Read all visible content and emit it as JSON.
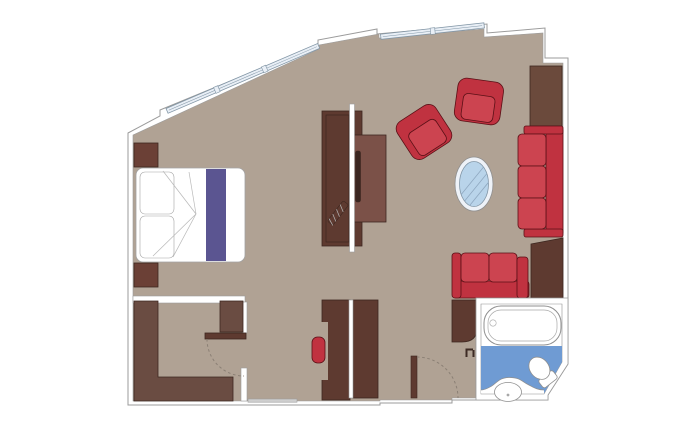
{
  "title": "Suite floor plan",
  "plan_type": "cruise-suite-floor-plan",
  "rooms": [
    {
      "name": "bedroom"
    },
    {
      "name": "living-area"
    },
    {
      "name": "walk-in-wardrobe"
    },
    {
      "name": "corridor"
    },
    {
      "name": "entrance"
    },
    {
      "name": "bathroom"
    }
  ],
  "furniture": [
    "double-bed",
    "pillows",
    "bed-runner",
    "nightstand",
    "tv-console",
    "glass-partition",
    "armchair",
    "oval-glass-table",
    "sofa-three-seat",
    "loveseat",
    "side-cabinet",
    "minibar-unit",
    "wardrobe-shelving",
    "desk-unit",
    "desk-chair",
    "entrance-door",
    "closet-door",
    "bathtub",
    "toilet",
    "washbasin",
    "vanity-counter",
    "window-strip"
  ],
  "colors": {
    "floor": "#b0a294",
    "wall_fill": "#ffffff",
    "wall_stroke": "#9b9b9b",
    "wood_dark": "#5e3a30",
    "wood_medium": "#6a4c42",
    "wood_light": "#7b5148",
    "wood_cabinet": "#6b4a3c",
    "wood_night": "#6b4036",
    "wood_stroke": "#3c2720",
    "red": "#c03240",
    "red_cushion": "#cc4450",
    "red_stroke": "#5a1016",
    "purple": "#5b5591",
    "window_fill": "#e9eff6",
    "window_stroke": "#8296a6",
    "glass_table": "#b9d4ea",
    "glass_rim": "#eef2f8",
    "glass_hatch": "#8fa8c0",
    "bath_floor": "#6f9bd3",
    "fixture_fill": "#ffffff",
    "fixture_stroke": "#8f8f8f",
    "fixture_inner": "#a8a8a8",
    "dash": "#8a7f74",
    "bed_stroke": "#a3a3a3",
    "bed_fold": "#b8b8b8",
    "tv_black": "#3a2520",
    "threshold": "#cfcfcf",
    "door_mark": "#3d2b24",
    "white": "#ffffff"
  }
}
